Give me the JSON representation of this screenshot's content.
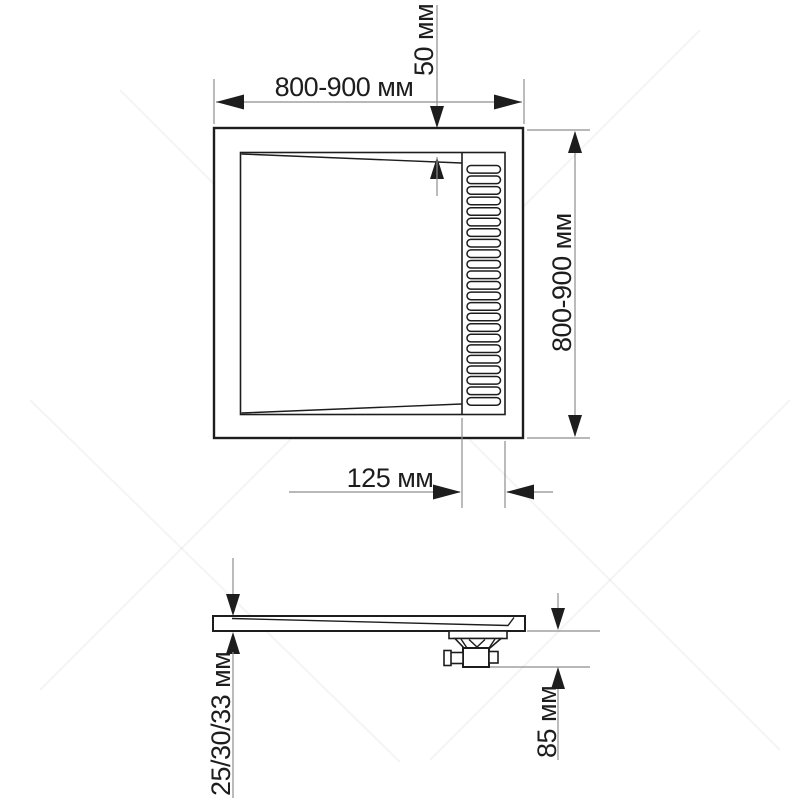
{
  "drawing": {
    "title": "shower-tray-dimension-drawing",
    "plan": {
      "dim_width_label": "800-900 мм",
      "dim_height_label": "800-900 мм",
      "dim_edge_to_basin_label": "50 мм",
      "dim_channel_label": "125 мм",
      "grate_slat_count": 23
    },
    "side": {
      "dim_thickness_label": "25/30/33 мм",
      "dim_drain_height_label": "85 мм"
    },
    "colors": {
      "line": "#1d1d1d",
      "dimension_line": "#8e8e8e",
      "background": "#ffffff"
    }
  }
}
